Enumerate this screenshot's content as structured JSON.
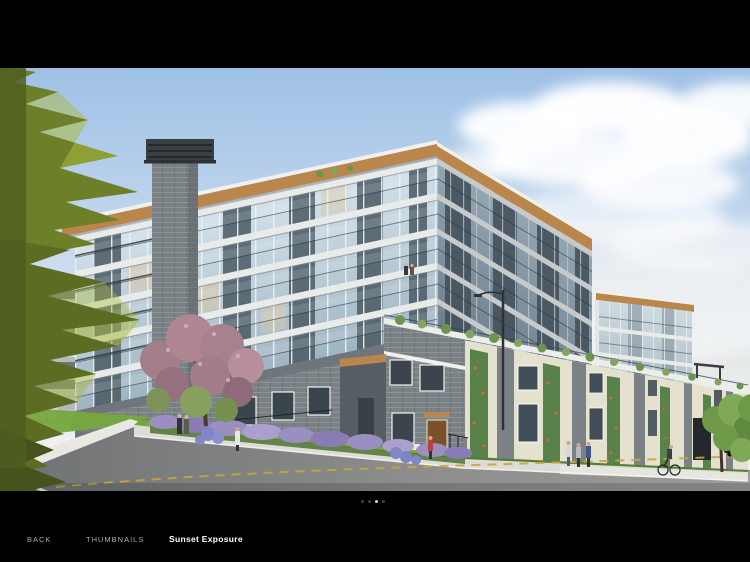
{
  "photo": {
    "alt": "Architectural rendering of a modern six-storey glass and grey-brick condominium building viewed from a sloping street corner at dusk, with landscaped sidewalks, flowering trees and pedestrians"
  },
  "pager": {
    "count": 4,
    "active_index": 2
  },
  "bottom_bar": {
    "back": "BACK",
    "thumbnails": "THUMBNAILS",
    "title": "Sunset Exposure"
  },
  "colors": {
    "bar_bg": "#000000",
    "label_dim": "#a9a9a9",
    "label_bright": "#ffffff",
    "dot_dim": "#3f3f3f",
    "dot_active": "#d6d6d6",
    "sky_top": "#9fc0e6",
    "sky_horizon": "#f1f2ef",
    "cloud": "#ffffff",
    "wood": "#b9874c",
    "fascia_white": "#f0f1ee",
    "glass_light": "#cfe0ea",
    "glass_dark": "#4d5d68",
    "mullion": "#f2f4f3",
    "slab": "#e9ebe9",
    "railing": "#2e3538",
    "brick_gray": "#7b8285",
    "brick_dark": "#5f666b",
    "chimney_cap": "#3a3f42",
    "cream": "#e5e1cf",
    "vine": "#59814a",
    "vine_bloom": "#cf6a31",
    "parapet": "#eceee9",
    "grass": "#76a83e",
    "hedge": "#567f36",
    "bush": "#6d9350",
    "road_dark": "#6f7274",
    "road_light": "#9c9b99",
    "sidewalk": "#dddcd6",
    "sidewalk_bright": "#e9e8e2",
    "curb": "#f5f5f2",
    "centerline": "#c9a43e",
    "shrub_purple": "#9a8fc0",
    "hydrangea": "#8087c5",
    "tree_pink": "#b08692",
    "tree_green": "#7e9357",
    "conifer_light": "#aabb3f",
    "conifer_mid": "#6d7f28",
    "conifer_dark": "#46531d",
    "distant": "#b6babb",
    "distant_win": "#61696d",
    "pole": "#2f3337",
    "car": "#26292c"
  }
}
